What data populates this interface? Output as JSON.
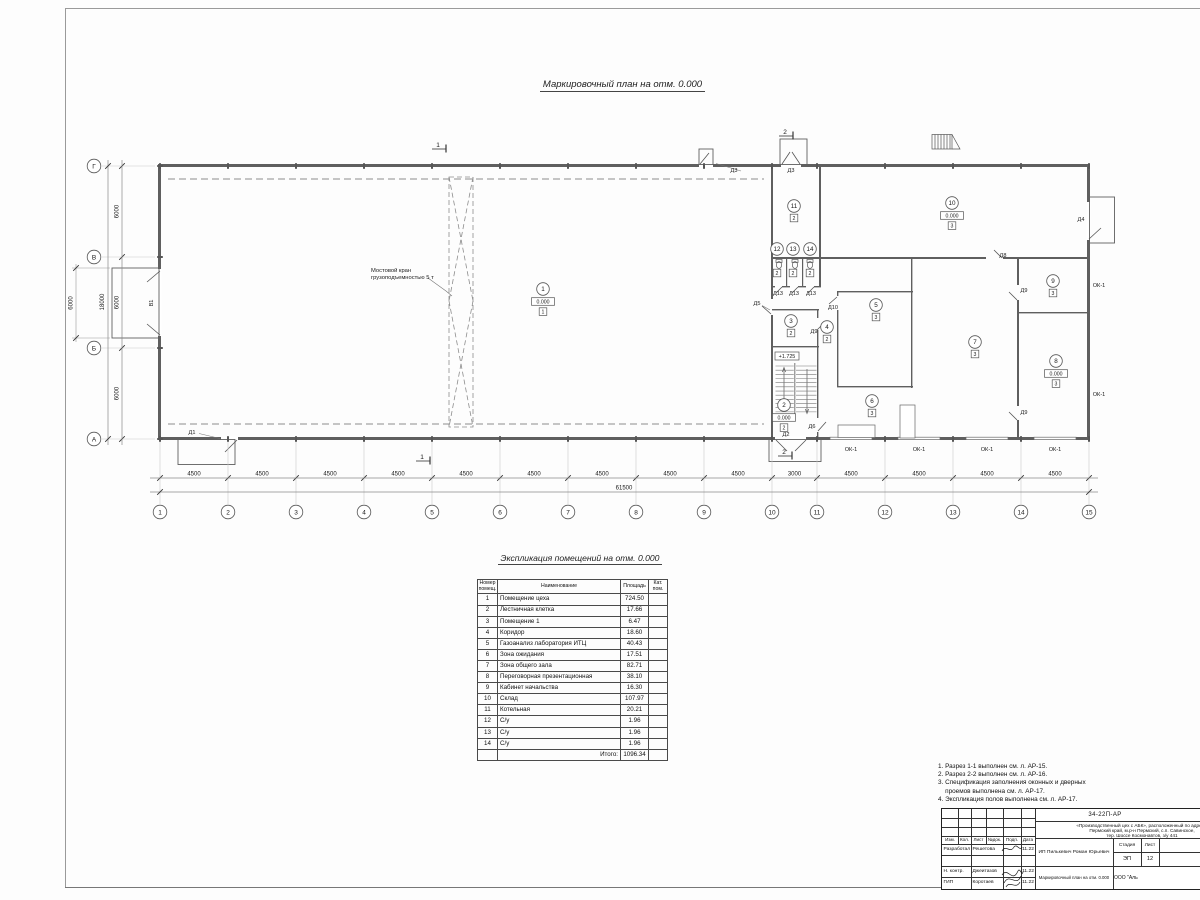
{
  "plan_title": "Маркировочный план  на отм. 0.000",
  "plan": {
    "axes_bottom": [
      "1",
      "2",
      "3",
      "4",
      "5",
      "6",
      "7",
      "8",
      "9",
      "10",
      "11",
      "12",
      "13",
      "14",
      "15"
    ],
    "dims_bottom": [
      "4500",
      "4500",
      "4500",
      "4500",
      "4500",
      "4500",
      "4500",
      "4500",
      "4500",
      "3000",
      "4500",
      "4500",
      "4500",
      "4500"
    ],
    "dim_total_bottom": "61500",
    "axes_left": [
      "Г",
      "В",
      "Б",
      "А"
    ],
    "dims_left": [
      "6000",
      "6000",
      "6000"
    ],
    "dim_total_left": "18000",
    "gate_dim": "6000",
    "crane_note_line1": "Мостовой кран",
    "crane_note_line2": "грузоподъемностью 5 т",
    "elevation_mark": "+1.725",
    "section_markers": [
      "1",
      "1",
      "2",
      "2"
    ],
    "opening_labels": [
      "В1",
      "Д1",
      "Д2",
      "Д3",
      "Д3",
      "Д4",
      "Д5",
      "Д6",
      "Д8",
      "Д9",
      "Д9",
      "Д9",
      "Д10",
      "Д13",
      "Д13",
      "Д13",
      "ОК-1",
      "ОК-1",
      "ОК-1",
      "ОК-1",
      "ОК-1",
      "ОК-1"
    ],
    "rooms": [
      {
        "num": "1",
        "elev": "0.000",
        "floor": "1"
      },
      {
        "num": "2",
        "elev": "0.000",
        "floor": "2"
      },
      {
        "num": "3",
        "floor": "2"
      },
      {
        "num": "4",
        "floor": "2"
      },
      {
        "num": "5",
        "floor": "3"
      },
      {
        "num": "6",
        "floor": "3"
      },
      {
        "num": "7",
        "floor": "3"
      },
      {
        "num": "8",
        "elev": "0.000",
        "floor": "3"
      },
      {
        "num": "9",
        "floor": "3"
      },
      {
        "num": "10",
        "elev": "0.000",
        "floor": "3"
      },
      {
        "num": "11",
        "floor": "2"
      },
      {
        "num": "12",
        "floor": "2",
        "wc": true
      },
      {
        "num": "13",
        "floor": "2",
        "wc": true
      },
      {
        "num": "14",
        "floor": "2",
        "wc": true
      }
    ]
  },
  "explication": {
    "title": "Экспликация помещений на отм. 0.000",
    "headers": {
      "num_l1": "Номер",
      "num_l2": "помещ.",
      "name": "Наименование",
      "area": "Площадь",
      "cat_l1": "Кат.",
      "cat_l2": "пом."
    },
    "rows": [
      [
        "1",
        "Помещение цеха",
        "724.50"
      ],
      [
        "2",
        "Лестничная клетка",
        "17.66"
      ],
      [
        "3",
        "Помещение 1",
        "6.47"
      ],
      [
        "4",
        "Коридор",
        "18.60"
      ],
      [
        "5",
        "Газоанализ лаборатория ИТЦ",
        "40.43"
      ],
      [
        "6",
        "Зона ожидания",
        "17.51"
      ],
      [
        "7",
        "Зона общего зала",
        "82.71"
      ],
      [
        "8",
        "Переговорная презентационная",
        "38.10"
      ],
      [
        "9",
        "Кабинет начальства",
        "16.30"
      ],
      [
        "10",
        "Склад",
        "107.97"
      ],
      [
        "11",
        "Котельная",
        "20.21"
      ],
      [
        "12",
        "С/у",
        "1.96"
      ],
      [
        "13",
        "С/у",
        "1.96"
      ],
      [
        "14",
        "С/у",
        "1.96"
      ]
    ],
    "total_label": "Итого:",
    "total_value": "1096.34"
  },
  "notes": [
    "1. Разрез 1-1 выполнен см. л. АР-15.",
    "2. Разрез 2-2 выполнен см. л. АР-16.",
    "3. Спецификация заполнения оконных и дверных",
    "    проемов выполнена см. л. АР-17.",
    "4. Экспликация полов выполнена см. л. АР-17."
  ],
  "titleblock": {
    "doc_number": "34-22П-АР",
    "object_line1": "«Производственный цех с АБК», расположенный по адресу:",
    "object_line2": "Пермский край, м.р-н Пермский, с.п. Савинское,",
    "object_line3": "тер. Шоссе Космонавтов, з/у 441",
    "cols": [
      "Изм.",
      "Кол.",
      "Лист",
      "№док.",
      "Подп.",
      "Дата"
    ],
    "rows": [
      {
        "role": "Разработал",
        "name": "Решетова",
        "date": "11.22"
      },
      {
        "role": "Н. контр.",
        "name": "Джеитазов",
        "date": "11.22"
      },
      {
        "role": "ГИП",
        "name": "Коротаев",
        "date": "11.22"
      }
    ],
    "client": "ИП Пилькевич Роман Юрьевич",
    "stage_label": "Стадия",
    "sheet_label": "Лист",
    "stage_value": "ЭП",
    "sheet_value": "12",
    "drawing_name": "Маркировочный план на отм. 0.000",
    "company": "ООО \"Аль"
  }
}
